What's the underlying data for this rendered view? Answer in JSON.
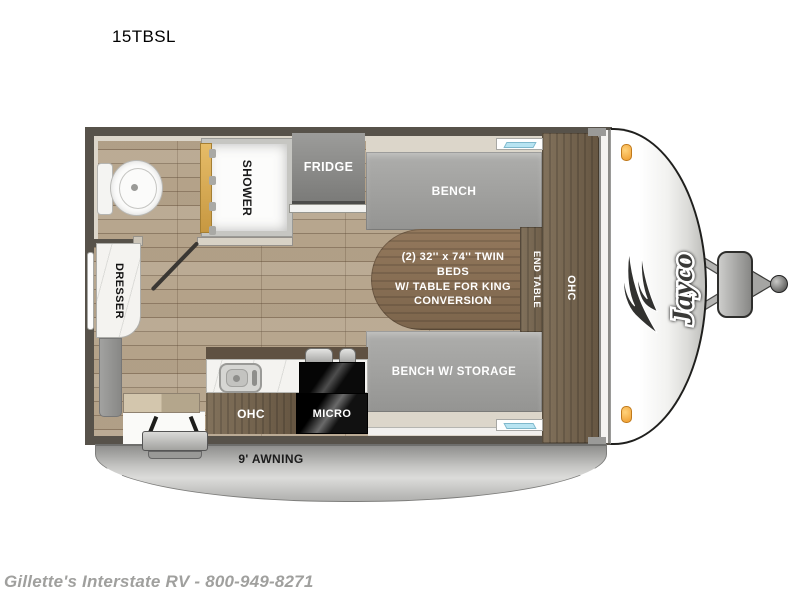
{
  "page": {
    "title": "15TBSL",
    "footer": "Gillette's Interstate RV - 800-949-8271"
  },
  "floorplan": {
    "brand": "Jayco",
    "awning_label": "9' AWNING",
    "labels": {
      "shower": "SHOWER",
      "fridge": "FRIDGE",
      "bench": "BENCH",
      "bed_table": "(2) 32'' x 74'' TWIN BEDS\nW/ TABLE FOR KING\nCONVERSION",
      "end_table": "END TABLE",
      "ohc_side": "OHC",
      "bench_storage": "BENCH W/ STORAGE",
      "ohc_kitchen": "OHC",
      "micro": "MICRO",
      "dresser": "DRESSER"
    },
    "colors": {
      "wall": "#57524a",
      "wood_floor": "#b7a68e",
      "cabinet_wood": "#75644f",
      "bench_gray": "#a2a2a0",
      "window_blue": "#b8e4f2",
      "marker_light": "#f2a73f",
      "awning_gray": "#c6c6c4"
    }
  }
}
